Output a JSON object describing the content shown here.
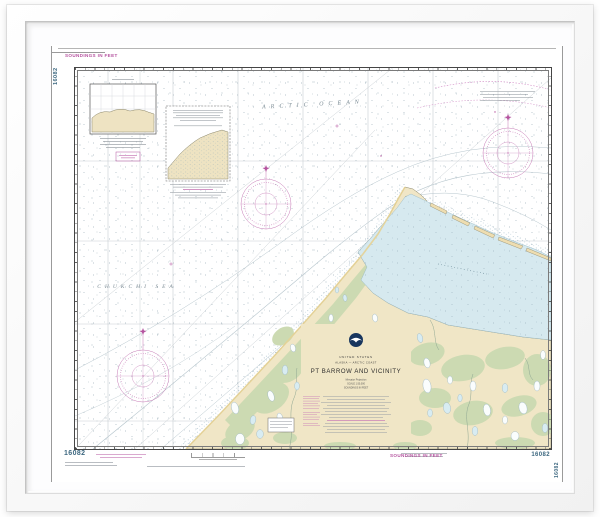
{
  "chart": {
    "number": "16082",
    "soundings_label": "SOUNDINGS IN FEET",
    "title_block": {
      "country": "UNITED STATES",
      "region": "ALASKA — ARCTIC COAST",
      "title": "PT BARROW AND VICINITY",
      "projection": "Mercator Projection",
      "scale": "SCALE 1:50,000",
      "datum_note": "SOUNDINGS IN FEET"
    },
    "labels": {
      "ocean": "ARCTIC OCEAN",
      "sea": "CHUKCHI SEA"
    },
    "colors": {
      "magenta_accent": "#b5539f",
      "land_tan": "#f0e6c6",
      "land_green": "#ccdab2",
      "lagoon_blue": "#d6e9ef",
      "number_blue": "#3d6880"
    }
  }
}
